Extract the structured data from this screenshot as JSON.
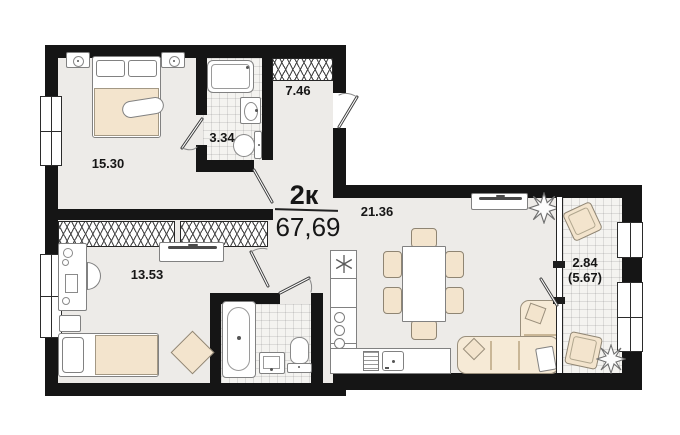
{
  "plan": {
    "apartment_type": "2к",
    "total_area": "67,69",
    "rooms": {
      "bedroom": "15.30",
      "bathroom_small": "3.34",
      "hallway": "7.46",
      "room_second": "13.53",
      "kitchen_living": "21.36",
      "balcony": "2.84",
      "balcony_total": "(5.67)"
    },
    "colors": {
      "wall": "#151515",
      "floor": "#edebe8",
      "accent_beige": "#f3e4cd",
      "outline_gray": "#818181"
    }
  }
}
